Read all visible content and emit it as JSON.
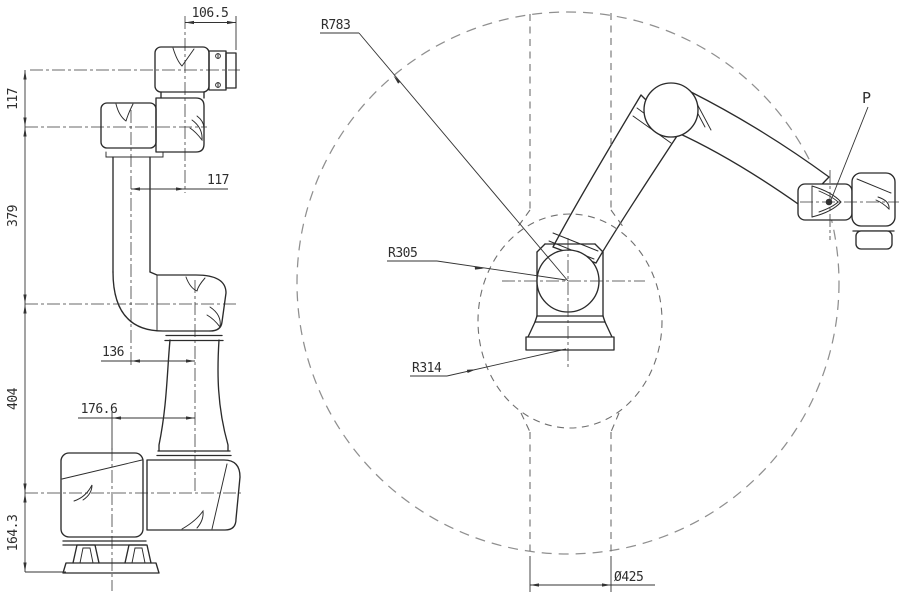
{
  "side_view": {
    "vertical_dims": [
      {
        "id": "wrist-to-flange",
        "label": "117"
      },
      {
        "id": "elbow-to-wrist",
        "label": "379"
      },
      {
        "id": "shoulder-to-elbow",
        "label": "404"
      },
      {
        "id": "base-to-shoulder",
        "label": "164.3"
      }
    ],
    "horizontal_dims": [
      {
        "id": "flange-offset",
        "label": "106.5"
      },
      {
        "id": "wrist-offset",
        "label": "117"
      },
      {
        "id": "elbow-offset",
        "label": "136"
      },
      {
        "id": "shoulder-offset",
        "label": "176.6"
      }
    ]
  },
  "workspace_view": {
    "outer_reach_radius": "R783",
    "inner_radius_upper": "R305",
    "inner_radius_lower": "R314",
    "column_diameter": "Ø425",
    "tool_point": "P"
  },
  "colors": {
    "line": "#2b2b2b",
    "dim": "#333333",
    "text": "#2e2e2e",
    "dashed_outer": "#8f8f8f",
    "dashed_inner": "#6f6f6f",
    "centerline": "#3a3a3a",
    "background": "#ffffff"
  }
}
